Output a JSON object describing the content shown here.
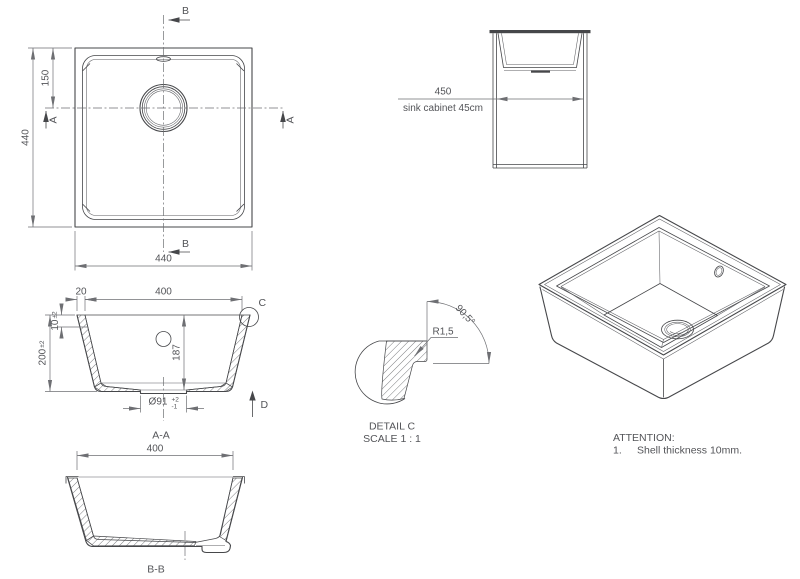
{
  "colors": {
    "line": "#46474a",
    "dim": "#6e6f73",
    "text": "#535458",
    "hatch": "#5e5f63",
    "background": "#ffffff"
  },
  "plan_view": {
    "section_a": "A",
    "section_b": "B",
    "dim_width": "440",
    "dim_height": "440",
    "dim_drain_from_top": "150"
  },
  "cabinet_view": {
    "dim_width": "450",
    "caption": "sink cabinet 45cm"
  },
  "section_aa": {
    "label": "A-A",
    "dim_wall_top": "20",
    "dim_opening": "400",
    "dim_rim_height": "10",
    "tol": "±2",
    "dim_total_height": "200",
    "dim_inner_depth": "187",
    "dim_drain_diameter": "Ø91",
    "drain_tol_plus": "+2",
    "drain_tol_minus": "-1",
    "detail_marker": "C",
    "direction_marker": "D"
  },
  "detail_c": {
    "radius": "R1,5",
    "angle": "90,5°",
    "title": "DETAIL C",
    "scale": "SCALE 1 : 1"
  },
  "section_bb": {
    "label": "B-B",
    "dim_opening": "400"
  },
  "attention": {
    "heading": "ATTENTION:",
    "item_no": "1.",
    "item_text": "Shell thickness 10mm."
  }
}
